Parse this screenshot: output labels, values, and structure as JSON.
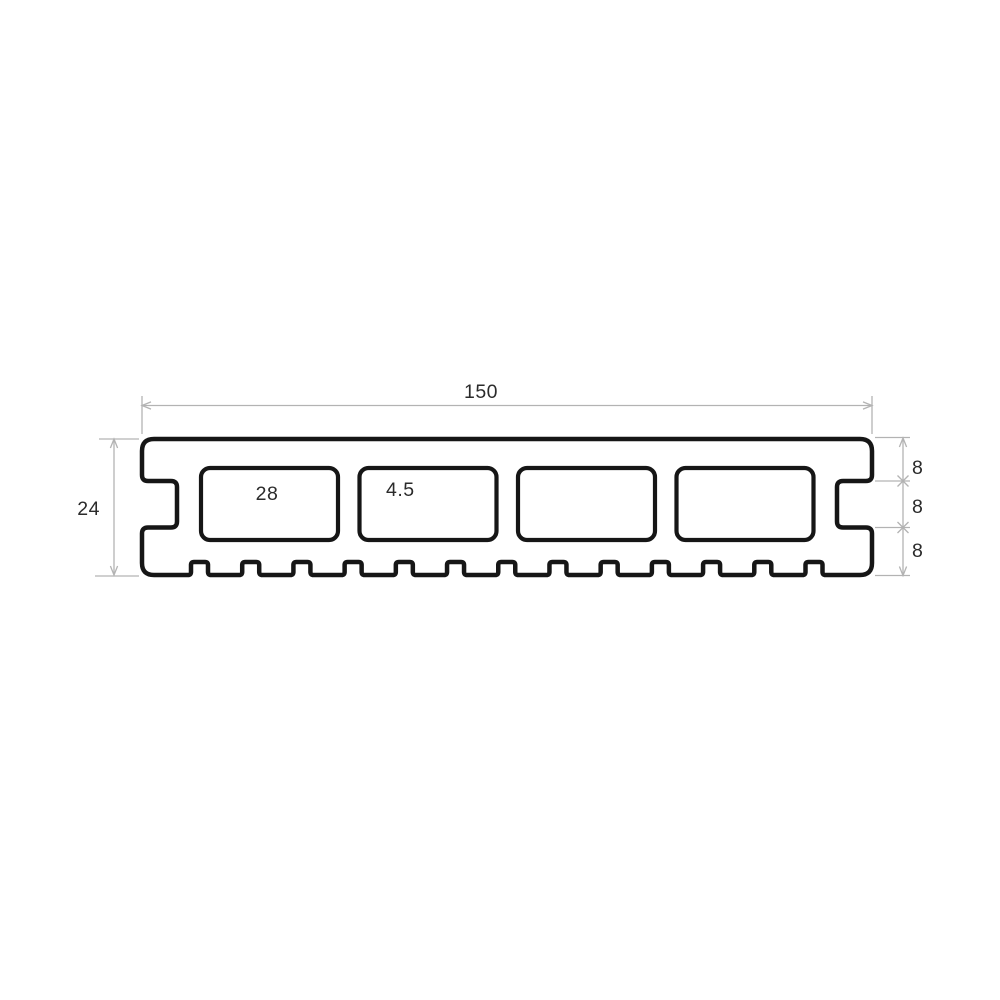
{
  "diagram": {
    "type": "technical-cross-section",
    "subject": "hollow composite decking board profile",
    "dimensions": {
      "overall_width": "150",
      "overall_height": "24",
      "cavity_width": "28",
      "cavity_gap": "4.5",
      "wall_top": "8",
      "groove_height": "8",
      "wall_bottom": "8"
    },
    "features": {
      "cavity_count": 4,
      "bottom_groove_count": 13,
      "side_groove_count": 2
    },
    "colors": {
      "outline": "#161616",
      "dimension_line": "#b3b3b3",
      "label_text": "#2b2b2b",
      "background": "#ffffff",
      "profile_fill": "#ffffff"
    }
  }
}
